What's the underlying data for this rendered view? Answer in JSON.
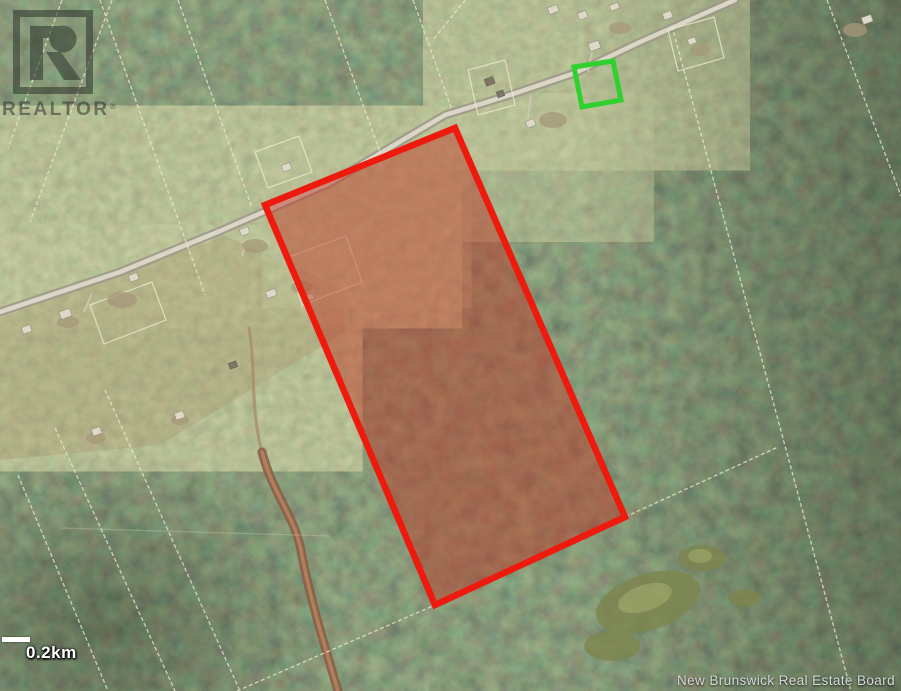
{
  "map": {
    "watermark": {
      "brand": "REALTOR",
      "registered_symbol": "®"
    },
    "scale_bar": {
      "label": "0.2km"
    },
    "attribution": "New Brunswick Real Estate Board",
    "overlays": {
      "subject_boundary": {
        "shape": "polygon",
        "points": "265,205 455,128 625,517 435,605",
        "stroke": "#ee1a0e",
        "fill": "rgba(190,55,38,0.48)"
      },
      "highlight_marker": {
        "shape": "rotated-square",
        "points": "574,67 613,61 621,100 582,107",
        "stroke": "#2ed12e"
      }
    },
    "icons": {
      "realtor_logo": "realtor-block-r-icon"
    },
    "colors": {
      "forest_green": "#3d4a30",
      "field_olive": "#80865a",
      "road_gray": "#ded9c9",
      "parcel_line": "#ebe8cd",
      "scale_white": "#ffffff",
      "attribution_gray": "#d9d9d9"
    }
  }
}
